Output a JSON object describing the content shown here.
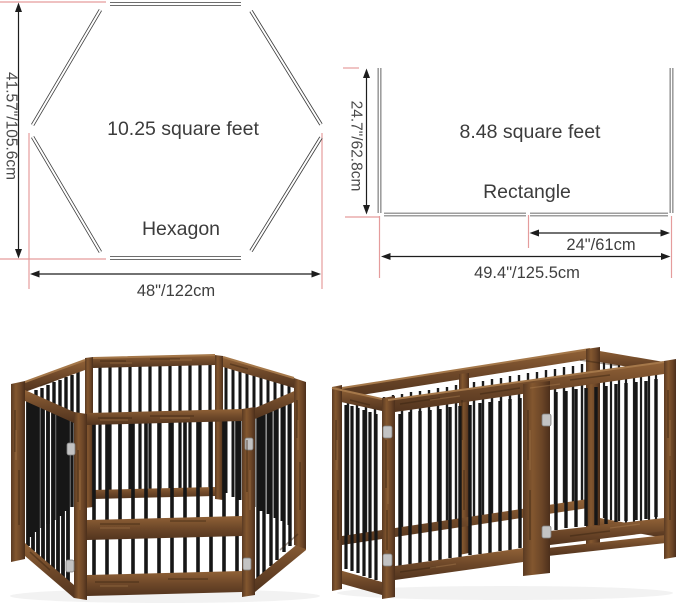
{
  "diagrams": {
    "hexagon": {
      "area_label": "10.25 square feet",
      "shape_label": "Hexagon",
      "height_dimension": "41.57\"/105.6cm",
      "width_dimension": "48\"/122cm"
    },
    "rectangle": {
      "area_label": "8.48 square feet",
      "shape_label": "Rectangle",
      "height_dimension": "24.7\"/62.8cm",
      "panel_dimension": "24\"/61cm",
      "width_dimension": "49.4\"/125.5cm"
    },
    "colors": {
      "dimension_line": "#1d1d1d",
      "panel_outline": "#3d3d3d",
      "guide_red": "#e59c9c",
      "label_text": "#3f3f3f"
    }
  },
  "photos": {
    "left": {
      "name": "hexagon-pen-photo",
      "depicts": "wooden 6-panel pet gate folded into hexagon playpen"
    },
    "right": {
      "name": "rectangle-pen-photo",
      "depicts": "wooden 6-panel pet gate folded into rectangle playpen"
    },
    "colors": {
      "wood_light": "#a5784a",
      "wood_mid": "#7a5130",
      "wood_dark": "#4f321d",
      "metal_bar": "#161616",
      "hinge": "#c3c3c3"
    }
  }
}
